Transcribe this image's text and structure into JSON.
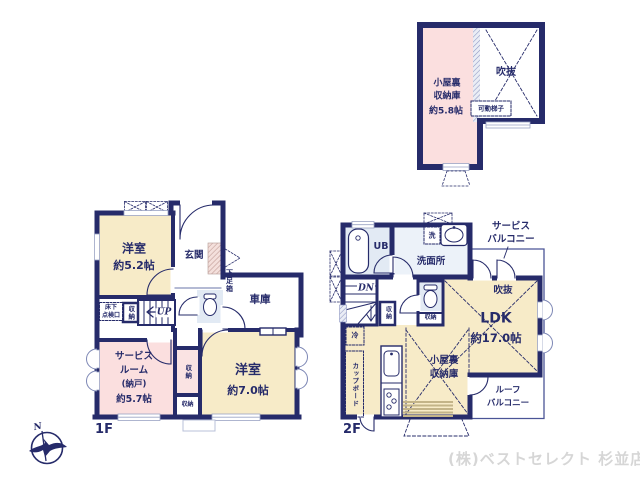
{
  "page": {
    "company": "(株)ベストセレクト 杉並店",
    "floor1_label": "1F",
    "floor2_label": "2F",
    "compass_north": "N"
  },
  "colors": {
    "wall_navy": "#262b6a",
    "room_yellow": "#f7ebc8",
    "room_pink": "#fbdfdf",
    "wet_area_blue": "#e2eaf4",
    "label_navy": "#262b6a",
    "company_gray": "#d6d6d6"
  },
  "attic": {
    "storage_name_lines": [
      "小屋裏",
      "収納庫"
    ],
    "storage_size": "約5.8帖",
    "void_label": "吹抜",
    "ladder_label": "可動梯子"
  },
  "floor1": {
    "bedroom1_name": "洋室",
    "bedroom1_size": "約5.2帖",
    "entrance_label": "玄関",
    "shoe_cabinet_label": "下足箱",
    "garage_label": "車庫",
    "underfloor_hatch_lines": [
      "床下",
      "点検口"
    ],
    "stair_closet_label": "収納",
    "stairs_up_label": "UP",
    "service_room_lines": [
      "サービス",
      "ルーム",
      "(納戸)",
      "約5.7帖"
    ],
    "closet_upper_label": "収納",
    "closet_lower_label": "収納",
    "bedroom2_name": "洋室",
    "bedroom2_size": "約7.0帖"
  },
  "floor2": {
    "unit_bath_label": "UB",
    "washer_label": "洗",
    "washroom_label": "洗面所",
    "service_balcony_lines": [
      "サービス",
      "バルコニー"
    ],
    "stairs_down_label": "DN",
    "hall_closet_label": "収納",
    "toilet_closet_label": "収納",
    "void_label": "吹抜",
    "ldk_name": "LDK",
    "ldk_size": "約17.0帖",
    "fridge_label": "冷",
    "cupboard_label": "カップボード",
    "attic_storage_lines": [
      "小屋裏",
      "収納庫"
    ],
    "roof_balcony_lines": [
      "ルーフ",
      "バルコニー"
    ]
  }
}
